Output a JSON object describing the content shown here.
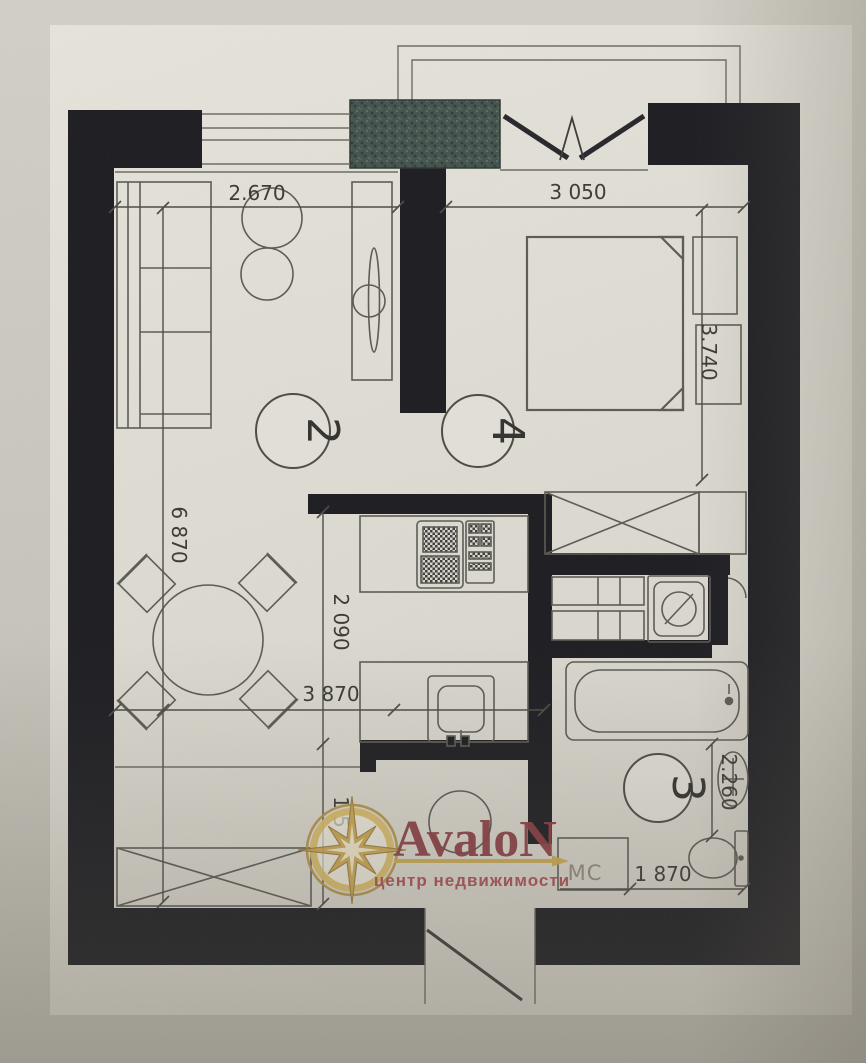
{
  "style": {
    "wall_color": "#1c1c21",
    "paper_color": "#e0ddd5",
    "photo_background": "#c9c6bd",
    "line_color": "#5b5a53",
    "hatch_color": "#44534d",
    "brand_gold": "#c9a84e",
    "brand_red": "#8a3c41",
    "tagline_red": "#a84a4f",
    "mc_gray": "#92897e"
  },
  "watermark": {
    "brand": "AvaloN",
    "tagline": "центр недвижимости"
  },
  "rooms": {
    "living": "2",
    "bedroom": "4",
    "bathroom": "3"
  },
  "labels": {
    "mc": "МС"
  },
  "dimensions": {
    "living_window_width": "2.670",
    "bedroom_window_width": "3 050",
    "bedroom_depth": "3.740",
    "apartment_depth": "6 870",
    "kitchen_width": "2 090",
    "living_width": "3 870",
    "bathroom_depth": "2.260",
    "bathroom_width": "1 870",
    "hall_depth_partial": "1 5"
  }
}
